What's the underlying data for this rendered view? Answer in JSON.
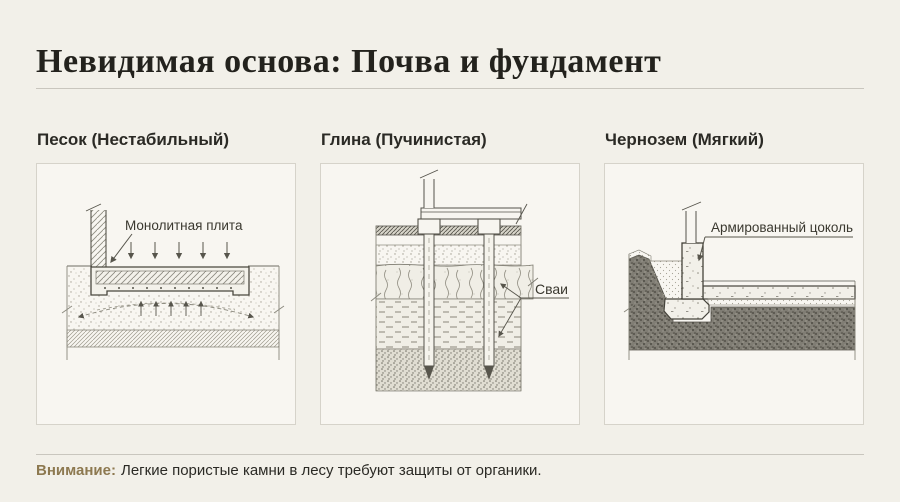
{
  "page": {
    "title": "Невидимая основа: Почва и фундамент"
  },
  "panels": [
    {
      "header": "Песок (Нестабильный)",
      "label": "Монолитная плита"
    },
    {
      "header": "Глина (Пучинистая)",
      "label": "Сваи"
    },
    {
      "header": "Чернозем (Мягкий)",
      "label": "Армированный цоколь"
    }
  ],
  "footer": {
    "warning_label": "Внимание:",
    "warning_text": "Легкие пористые камни в лесу требуют защиты от органики."
  },
  "colors": {
    "background": "#f2f0e9",
    "accent": "#8d7950",
    "ink": "#2b2a25",
    "drawing_line": "#57554c"
  }
}
